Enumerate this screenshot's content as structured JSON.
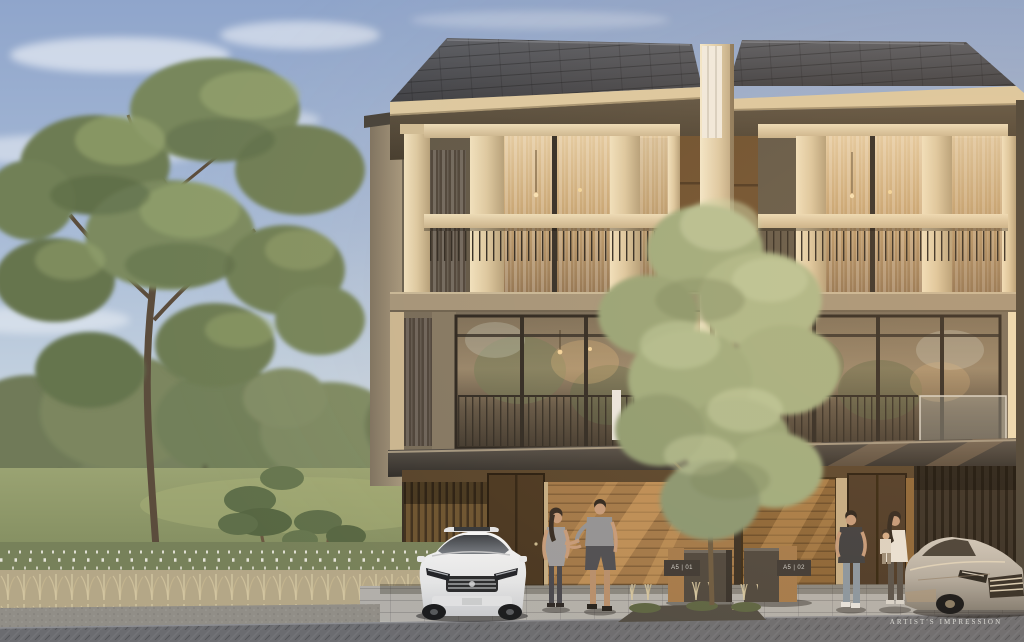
{
  "image": {
    "kind": "architectural rendering of two attached three-storey modern townhouses with carports, park landscape, two cars and four residents",
    "caption": "ARTIST'S IMPRESSION"
  },
  "unit_plates": [
    {
      "label": "A5 | 01"
    },
    {
      "label": "A5 | 02"
    }
  ],
  "palette": {
    "sky_top": "#8fa5cb",
    "sky_horizon": "#e9ebe3",
    "roof_slate": "#45474c",
    "fascia_cream": "#dcc9a1",
    "wall_taupe": "#746a59",
    "wall_recess": "#5e5647",
    "wood_warm": "#a07748",
    "wood_dark": "#473520",
    "foliage_dark": "#6d7c52",
    "foliage_light": "#a9b88a",
    "lawn_green": "#8b9468",
    "dry_grass": "#bcae8e",
    "driveway_light": "#b1afaa",
    "road_dark": "#6b6c70",
    "car_white": "#eceff1",
    "car_silver": "#c6c0b6",
    "glass_warm": "#d9bf96",
    "glass_reflect": "#8d7c62"
  }
}
